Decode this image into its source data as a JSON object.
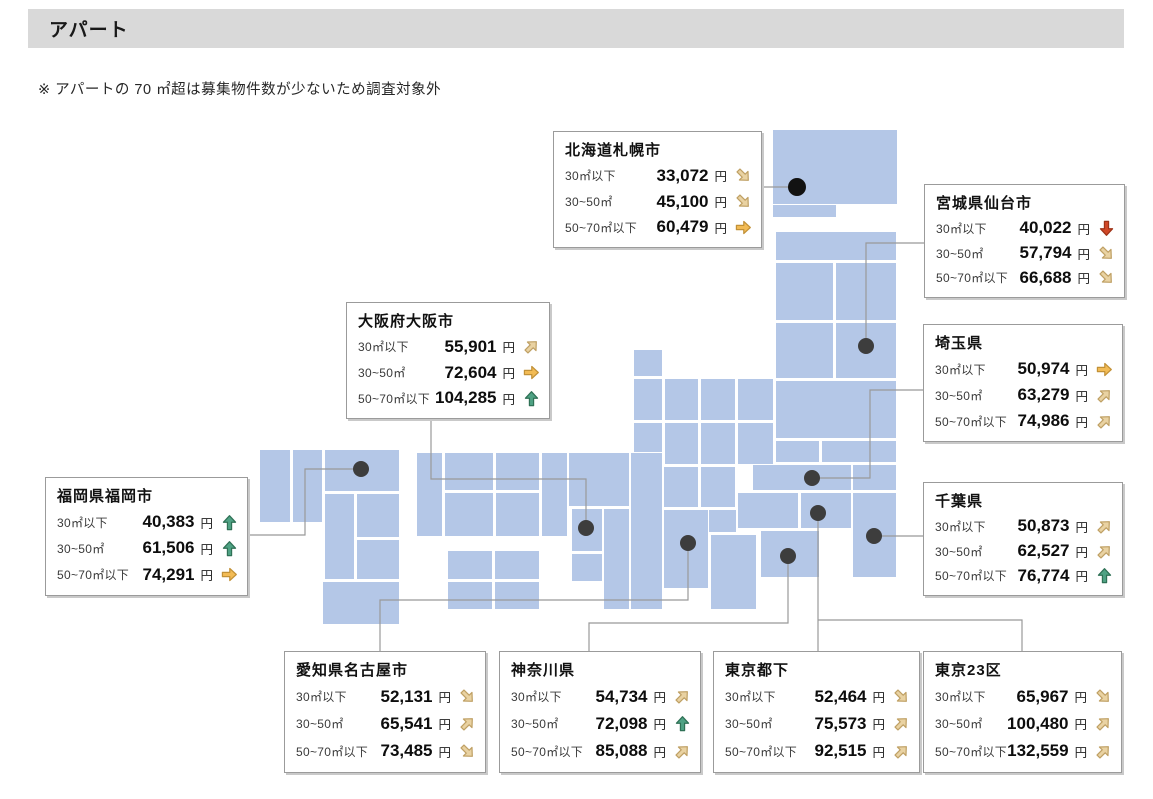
{
  "page": {
    "title": "アパート",
    "note": "※ アパートの 70 ㎡超は募集物件数が少ないため調査対象外"
  },
  "regions": [
    {
      "id": "sapporo",
      "name": "北海道札幌市",
      "box": {
        "x": 553,
        "y": 131,
        "w": 209,
        "h": 117
      },
      "rows": [
        {
          "label": "30㎡以下",
          "value": "33,072",
          "unit": "円",
          "trend": "down-right"
        },
        {
          "label": "30~50㎡",
          "value": "45,100",
          "unit": "円",
          "trend": "down-right"
        },
        {
          "label": "50~70㎡以下",
          "value": "60,479",
          "unit": "円",
          "trend": "right"
        }
      ]
    },
    {
      "id": "sendai",
      "name": "宮城県仙台市",
      "box": {
        "x": 924,
        "y": 184,
        "w": 201,
        "h": 114
      },
      "rows": [
        {
          "label": "30㎡以下",
          "value": "40,022",
          "unit": "円",
          "trend": "down"
        },
        {
          "label": "30~50㎡",
          "value": "57,794",
          "unit": "円",
          "trend": "down-right"
        },
        {
          "label": "50~70㎡以下",
          "value": "66,688",
          "unit": "円",
          "trend": "down-right"
        }
      ]
    },
    {
      "id": "saitama",
      "name": "埼玉県",
      "box": {
        "x": 923,
        "y": 324,
        "w": 200,
        "h": 118
      },
      "rows": [
        {
          "label": "30㎡以下",
          "value": "50,974",
          "unit": "円",
          "trend": "right"
        },
        {
          "label": "30~50㎡",
          "value": "63,279",
          "unit": "円",
          "trend": "up-right"
        },
        {
          "label": "50~70㎡以下",
          "value": "74,986",
          "unit": "円",
          "trend": "up-right"
        }
      ]
    },
    {
      "id": "osaka",
      "name": "大阪府大阪市",
      "box": {
        "x": 346,
        "y": 302,
        "w": 204,
        "h": 117
      },
      "rows": [
        {
          "label": "30㎡以下",
          "value": "55,901",
          "unit": "円",
          "trend": "up-right"
        },
        {
          "label": "30~50㎡",
          "value": "72,604",
          "unit": "円",
          "trend": "right"
        },
        {
          "label": "50~70㎡以下",
          "value": "104,285",
          "unit": "円",
          "trend": "up"
        }
      ]
    },
    {
      "id": "chiba",
      "name": "千葉県",
      "box": {
        "x": 923,
        "y": 482,
        "w": 200,
        "h": 114
      },
      "rows": [
        {
          "label": "30㎡以下",
          "value": "50,873",
          "unit": "円",
          "trend": "up-right"
        },
        {
          "label": "30~50㎡",
          "value": "62,527",
          "unit": "円",
          "trend": "up-right"
        },
        {
          "label": "50~70㎡以下",
          "value": "76,774",
          "unit": "円",
          "trend": "up"
        }
      ]
    },
    {
      "id": "fukuoka",
      "name": "福岡県福岡市",
      "box": {
        "x": 45,
        "y": 477,
        "w": 203,
        "h": 119
      },
      "rows": [
        {
          "label": "30㎡以下",
          "value": "40,383",
          "unit": "円",
          "trend": "up"
        },
        {
          "label": "30~50㎡",
          "value": "61,506",
          "unit": "円",
          "trend": "up"
        },
        {
          "label": "50~70㎡以下",
          "value": "74,291",
          "unit": "円",
          "trend": "right"
        }
      ]
    },
    {
      "id": "nagoya",
      "name": "愛知県名古屋市",
      "box": {
        "x": 284,
        "y": 651,
        "w": 202,
        "h": 122
      },
      "rows": [
        {
          "label": "30㎡以下",
          "value": "52,131",
          "unit": "円",
          "trend": "down-right"
        },
        {
          "label": "30~50㎡",
          "value": "65,541",
          "unit": "円",
          "trend": "up-right"
        },
        {
          "label": "50~70㎡以下",
          "value": "73,485",
          "unit": "円",
          "trend": "down-right"
        }
      ]
    },
    {
      "id": "kanagawa",
      "name": "神奈川県",
      "box": {
        "x": 499,
        "y": 651,
        "w": 202,
        "h": 122
      },
      "rows": [
        {
          "label": "30㎡以下",
          "value": "54,734",
          "unit": "円",
          "trend": "up-right"
        },
        {
          "label": "30~50㎡",
          "value": "72,098",
          "unit": "円",
          "trend": "up"
        },
        {
          "label": "50~70㎡以下",
          "value": "85,088",
          "unit": "円",
          "trend": "up-right"
        }
      ]
    },
    {
      "id": "tokyo-tama",
      "name": "東京都下",
      "box": {
        "x": 713,
        "y": 651,
        "w": 207,
        "h": 122
      },
      "rows": [
        {
          "label": "30㎡以下",
          "value": "52,464",
          "unit": "円",
          "trend": "down-right"
        },
        {
          "label": "30~50㎡",
          "value": "75,573",
          "unit": "円",
          "trend": "up-right"
        },
        {
          "label": "50~70㎡以下",
          "value": "92,515",
          "unit": "円",
          "trend": "up-right"
        }
      ]
    },
    {
      "id": "tokyo-23",
      "name": "東京23区",
      "box": {
        "x": 923,
        "y": 651,
        "w": 199,
        "h": 122
      },
      "rows": [
        {
          "label": "30㎡以下",
          "value": "65,967",
          "unit": "円",
          "trend": "down-right"
        },
        {
          "label": "30~50㎡",
          "value": "100,480",
          "unit": "円",
          "trend": "up-right"
        },
        {
          "label": "50~70㎡以下",
          "value": "132,559",
          "unit": "円",
          "trend": "up-right"
        }
      ]
    }
  ],
  "trend_colors": {
    "up": {
      "fill": "#4fa284",
      "stroke": "#2f7156"
    },
    "down": {
      "fill": "#d04727",
      "stroke": "#9e3318"
    },
    "right": {
      "fill": "#f2bb55",
      "stroke": "#c29137"
    },
    "up-right": {
      "fill": "#e9d2a2",
      "stroke": "#bfa064"
    },
    "down-right": {
      "fill": "#e9d2a2",
      "stroke": "#bfa064"
    }
  },
  "map": {
    "tile_color": "#b4c7e7",
    "tile_border": "#ffffff",
    "dot_color": "#3d3d3d",
    "connector_color": "#999999",
    "tiles": [
      [
        772,
        129,
        126,
        76
      ],
      [
        772,
        204,
        65,
        14
      ],
      [
        775,
        231,
        122,
        30
      ],
      [
        775,
        262,
        59,
        59
      ],
      [
        835,
        262,
        62,
        59
      ],
      [
        775,
        322,
        59,
        57
      ],
      [
        835,
        322,
        62,
        57
      ],
      [
        775,
        380,
        122,
        59
      ],
      [
        633,
        349,
        30,
        28
      ],
      [
        633,
        378,
        30,
        43
      ],
      [
        664,
        378,
        35,
        43
      ],
      [
        700,
        378,
        36,
        43
      ],
      [
        737,
        378,
        37,
        43
      ],
      [
        633,
        422,
        30,
        43
      ],
      [
        664,
        422,
        35,
        43
      ],
      [
        700,
        422,
        36,
        43
      ],
      [
        737,
        422,
        37,
        43
      ],
      [
        775,
        440,
        45,
        23
      ],
      [
        821,
        440,
        76,
        23
      ],
      [
        752,
        464,
        100,
        27
      ],
      [
        852,
        464,
        45,
        27
      ],
      [
        800,
        492,
        52,
        37
      ],
      [
        852,
        492,
        45,
        86
      ],
      [
        760,
        530,
        60,
        48
      ],
      [
        737,
        492,
        62,
        37
      ],
      [
        663,
        466,
        36,
        42
      ],
      [
        700,
        466,
        36,
        42
      ],
      [
        700,
        509,
        37,
        24
      ],
      [
        663,
        509,
        46,
        80
      ],
      [
        710,
        534,
        47,
        76
      ],
      [
        568,
        452,
        62,
        55
      ],
      [
        571,
        508,
        32,
        44
      ],
      [
        603,
        508,
        27,
        102
      ],
      [
        571,
        553,
        32,
        29
      ],
      [
        630,
        452,
        33,
        158
      ],
      [
        416,
        452,
        27,
        85
      ],
      [
        444,
        452,
        50,
        39
      ],
      [
        495,
        452,
        45,
        39
      ],
      [
        541,
        452,
        27,
        85
      ],
      [
        444,
        492,
        50,
        45
      ],
      [
        495,
        492,
        45,
        45
      ],
      [
        447,
        550,
        46,
        30
      ],
      [
        494,
        550,
        46,
        30
      ],
      [
        447,
        581,
        46,
        29
      ],
      [
        494,
        581,
        46,
        29
      ],
      [
        259,
        449,
        32,
        74
      ],
      [
        292,
        449,
        31,
        74
      ],
      [
        324,
        449,
        76,
        43
      ],
      [
        324,
        493,
        31,
        87
      ],
      [
        356,
        493,
        44,
        45
      ],
      [
        356,
        539,
        44,
        41
      ],
      [
        322,
        581,
        78,
        44
      ]
    ],
    "dots": [
      {
        "id": "hokkaido",
        "x": 797,
        "y": 187,
        "r": 9,
        "color": "#121212"
      },
      {
        "id": "miyagi",
        "x": 866,
        "y": 346,
        "r": 8
      },
      {
        "id": "saitama",
        "x": 812,
        "y": 478,
        "r": 8
      },
      {
        "id": "tokyo",
        "x": 818,
        "y": 513,
        "r": 8
      },
      {
        "id": "chiba",
        "x": 874,
        "y": 536,
        "r": 8
      },
      {
        "id": "kanagawa",
        "x": 788,
        "y": 556,
        "r": 8
      },
      {
        "id": "aichi",
        "x": 688,
        "y": 543,
        "r": 8
      },
      {
        "id": "osaka",
        "x": 586,
        "y": 528,
        "r": 8
      },
      {
        "id": "fukuoka",
        "x": 361,
        "y": 469,
        "r": 8
      }
    ],
    "connectors": [
      {
        "id": "sapporo",
        "points": "762,187 790,187"
      },
      {
        "id": "sendai",
        "points": "924,243 866,243 866,339"
      },
      {
        "id": "saitama",
        "points": "923,390 870,390 870,478 819,478"
      },
      {
        "id": "chiba",
        "points": "923,536 881,536"
      },
      {
        "id": "osaka",
        "points": "431,419 431,479 586,479 586,521"
      },
      {
        "id": "fukuoka",
        "points": "248,535 305,535 305,469 354,469"
      },
      {
        "id": "nagoya",
        "points": "688,550 688,600 380,600 380,651"
      },
      {
        "id": "kanagawa",
        "points": "788,563 788,623 589,623 589,651"
      },
      {
        "id": "tokyo-tama",
        "points": "818,520 818,651"
      },
      {
        "id": "tokyo-23",
        "points": "818,620 1022,620 1022,651"
      }
    ]
  },
  "chart_data": {
    "type": "table",
    "title": "アパート",
    "note": "※ アパートの 70 ㎡超は募集物件数が少ないため調査対象外",
    "columns": [
      "地域",
      "30㎡以下",
      "30~50㎡",
      "50~70㎡以下"
    ],
    "unit": "円",
    "rows": [
      [
        "北海道札幌市",
        33072,
        45100,
        60479
      ],
      [
        "宮城県仙台市",
        40022,
        57794,
        66688
      ],
      [
        "埼玉県",
        50974,
        63279,
        74986
      ],
      [
        "千葉県",
        50873,
        62527,
        76774
      ],
      [
        "東京23区",
        65967,
        100480,
        132559
      ],
      [
        "東京都下",
        52464,
        75573,
        92515
      ],
      [
        "神奈川県",
        54734,
        72098,
        85088
      ],
      [
        "愛知県名古屋市",
        52131,
        65541,
        73485
      ],
      [
        "大阪府大阪市",
        55901,
        72604,
        104285
      ],
      [
        "福岡県福岡市",
        40383,
        61506,
        74291
      ]
    ],
    "trend_legend": [
      "up=上昇",
      "up-right=やや上昇",
      "right=横ばい",
      "down-right=やや下落",
      "down=下落"
    ]
  }
}
